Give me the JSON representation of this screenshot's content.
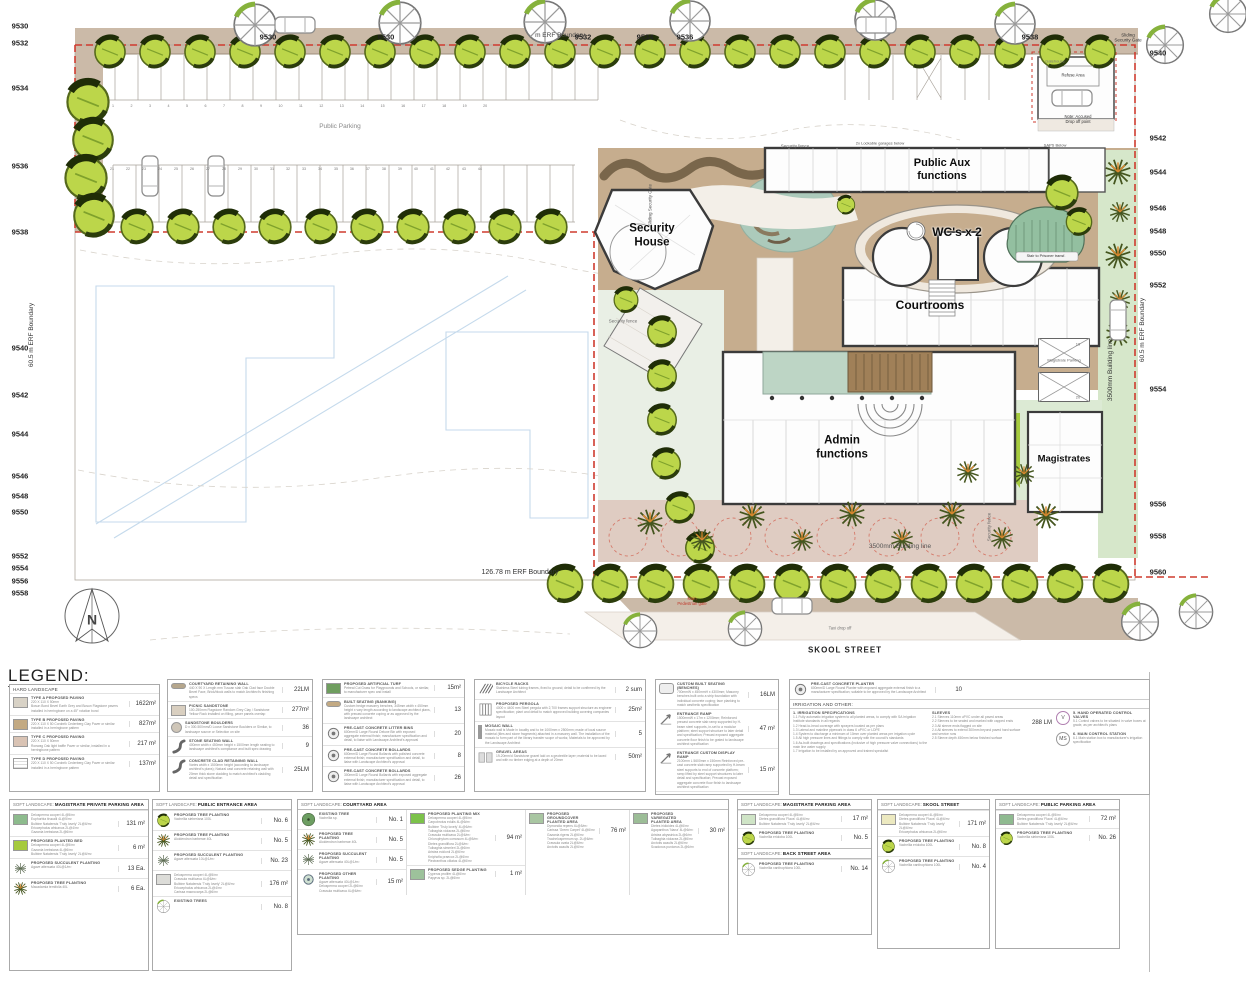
{
  "title": "LEGEND:",
  "plan": {
    "compass": "N",
    "buildings": {
      "security_house": "Security\nHouse",
      "public_aux": "Public Aux\nfunctions",
      "wcs": "WC's x 2",
      "courtrooms": "Courtrooms",
      "admin": "Admin\nfunctions",
      "magistrates": "Magistrates"
    },
    "labels": {
      "skool_street": "SKOOL STREET",
      "erf_left": "60.5 m ERF Boundary",
      "erf_right": "60.5 m ERF Boundary",
      "erf_bottom": "126.78 m ERF Boundary",
      "erf_top": "m ERF Boundary",
      "building_line_v": "3500mm Building line",
      "building_line_h": "3500mm Building line",
      "security_fence": "Security fence",
      "sliding_gate": "Sliding\nSecurity Gate",
      "sliding_gate_v": "Sliding Security Gate",
      "refuse_area": "Refuse Area",
      "gatehouse": "Gatehouse",
      "accused_note": "Note: Accused\nDrop off point",
      "garages_note": "2x Lockable garages below",
      "saps_note": "SAPS Below",
      "prisoner_stair": "Stair to Prisoner transf.",
      "main_gate": "Main\nPedestrian gate",
      "taxi": "Taxi drop off",
      "public_parking": "Public Parking",
      "magistrate_parking": "Magistrate Parking",
      "stall_19": "19",
      "stall_20": "20",
      "stall_numbers_row1": "1 2 3 4 5 6 7 8 9 10 11 12 13 14 15 16 17 18 19 20",
      "stall_numbers_row2": "21 22 23 24 25 26 27 28 29 30 31 32 33 34 35 36 37 38 39 40 41 42 43 44"
    },
    "contours": {
      "top": [
        "9530",
        "9530",
        "9532",
        "9534",
        "9536",
        "9538"
      ],
      "left": [
        "9530",
        "9532",
        "9534",
        "9536",
        "9538",
        "9540",
        "9542",
        "9544",
        "9546",
        "9548",
        "9550",
        "9552",
        "9554",
        "9556",
        "9558"
      ],
      "right": [
        "9540",
        "9542",
        "9544",
        "9546",
        "9548",
        "9550",
        "9552",
        "9554",
        "9556",
        "9558",
        "9560"
      ]
    }
  },
  "legend": {
    "hard": {
      "header": "HARD LANDSCAPE",
      "a": [
        {
          "n": "TYPE A PROPOSED PAVING",
          "d": "220 X 110 X 50mm\nBosun Bond Bevel Earth Grey and Bosun Flagstone pavers installed in herringbone on a 45° rotation bond",
          "v": "1622m²"
        },
        {
          "n": "TYPE B PROPOSED PAVING",
          "d": "220 X 110 X 50 Corobrik Cederberg Clay Paver or similar installed in a herringbone pattern",
          "v": "827m²"
        },
        {
          "n": "TYPE C PROPOSED PAVING",
          "d": "220 X 110 X 50mm\nRoewag Oak light baffle Paver or similar, installed in a herringbone pattern",
          "v": "217 m²"
        },
        {
          "n": "TYPE D PROPOSED PAVING",
          "d": "220 X 110 X 50 Corobrik Cederberg Clay Paver or similar installed in a herringbone pattern",
          "v": "137m²"
        }
      ],
      "b": [
        {
          "n": "COURTYARD RETAINING WALL",
          "d": "440 X 90 X Length mm Tuscan slab Oak Clad face Double Bevel Face, Brick/block walls to match Architect's finishing specs",
          "v": "22LM"
        },
        {
          "n": "PICNIC SANDSTONE",
          "d": "100-250mm Flagstone Random Grey Clay / Sandstone Yellow Rock installed on filling, paver panels overlap",
          "v": "277m²"
        },
        {
          "n": "SANDSTONE BOULDERS",
          "d": "D x 300-500mm/D Loose Sandstone Boulders or Similar, to landscape source or Selection on site",
          "v": "36"
        },
        {
          "n": "STONE SEATING WALL",
          "d": "400mm width x 450mm height x 1500mm length seating to landscape architect's compliance and built spec drawing",
          "v": "9"
        },
        {
          "n": "CONCRETE CLAD RETAINING WALL",
          "d": "Varies width x 1500mm height (according to landscape architect's plans); Natural cast concrete retaining wall with 20mm thick stone cladding to match architect's cladding detail and specification",
          "v": "25LM"
        }
      ],
      "c": [
        {
          "n": "PROPOSED ARTIFICIAL TURF",
          "d": "Petreal Cut Grass for Playgrounds and Schools, or similar, to manufacturer spec and install",
          "v": "15m²"
        },
        {
          "n": "BUILT SEATING (BANKING)",
          "d": "Custom hedge masonry benches, 345mm width x 450mm height x vary length according to landscape architect plans, with precast concrete coping or as approved by the landscape architect",
          "v": "13"
        },
        {
          "n": "PRE-CAST CONCRETE LITTER BINS",
          "d": "600mm/D Large Round Deluxe Bin with exposed aggregate external finish; manufacturer specification and detail, to liaise with Landscape Architect's approval",
          "v": "20"
        },
        {
          "n": "PRE-CAST CONCRETE BOLLARDS",
          "d": "600mm/D Large Round Bollards with polished concrete external finish; manufacturer specification and detail, to liaise with Landscape Architect's approval",
          "v": "8"
        },
        {
          "n": "PRE-CAST CONCRETE BOLLARDS",
          "d": "300mm/D Large Round Bollards with exposed aggregate external finish; manufacturer specification and detail, to liaise with Landscape Architect's approval",
          "v": "26"
        }
      ],
      "d": [
        {
          "n": "BICYCLE RACKS",
          "d": "Stainless Steel tubing frames, fixed to ground; detail to be confirmed by the Landscape Architect",
          "v": "2 sum"
        },
        {
          "n": "PROPOSED PERGOLA",
          "d": "4000 x 4400 mm Steel pergola with 2,700 frames support structure as engineer specification; plant and detail to match approved building covering companies layout",
          "v": "25m²"
        },
        {
          "n": "MOSAIC WALL",
          "d": "Mosaic wall is Made in locality and to be 1000mm x 2500mm; made of local source material (tiles and stone fragments) attached in a masonry wall. The installation of the mosaic to form part of the library transfer scope of works; Materials to be approved by the Landscape Architect",
          "v": "5"
        },
        {
          "n": "GRAVEL AREAS",
          "d": "19-20mm/d Sandstone gravel laid on a geotextile layer; material to be laced and with no timber edging at a depth of 20mm",
          "v": "50m²"
        }
      ],
      "e": [
        {
          "n": "CUSTOM BUILT SEATING (BENCHES)",
          "d": "700mmW x 450mmH x 4300mm; Masonry benches built onto a strip foundation with individual concrete coping; face planking to match aesthetic specification",
          "v": "16LM"
        },
        {
          "n": "ENTRANCE RAMP",
          "d": "1500mmW x 17m x 1200mm; Reinforced precast concrete slab ramp supported by H-beam steel supports, in-set to a modular platform; steel support structure to later detail and specification; Precast exposed aggregate concrete floor finish to be grated to landscape architect specification",
          "v": "47 m²"
        },
        {
          "n": "ENTRANCE CUSTOM DISPLAY RAMP",
          "d": "2100mm L 5600mm x 150mm Reinforced pre-cast concrete slab ramp supported by H-beam steel supports to end of concrete platform; ramp lifted by steel support structures to later detail and specification; Precast exposed aggregate concrete floor finish to landscape architect specification",
          "v": "15 m²"
        },
        {
          "n": "ARTISTIC STEEL SCREENWALL",
          "d": "L-Shaped panels; coated steel of various heights with laser-cut floral art; to be fixed onto fill beam; to later technical detail and specification",
          "v": "23 LM"
        }
      ],
      "f": {
        "n": "PRE-CAST CONCRETE PLANTER",
        "d": "600mm/D Large Round Planter with exposed aggregate external finish to a manufacturer specification; suitable to be approved by the Landscape Architect",
        "v": "10"
      },
      "irr": {
        "header": "IRRIGATION AND OTHER:",
        "spec_t": "1.   IRRIGATION SPECIFICATIONS",
        "spec_x": "1.1 Fully automatic irrigation system to all planted areas, to comply with SA Irrigation Institute standards in all regards\n1.2 Head-to-head coverage with sprayers located as per plans\n1.3 Lateral and mainline pipework in class 6 uPVC or LDPE\n1.4 System to discharge a minimum of 10mm over planted areas per irrigation cycle\n1.5 All high pressure lines and fittings to comply with the council's standards\n1.6 As-built drawings and specifications (inclusive of high pressure valve connections) to the main line water supply\n1.7 Irrigation to be installed by an approved and trained specialist",
        "slv_t": "SLEEVES",
        "slv_x": "2.1 Sleeves 110mm uPVC under all paved areas\n2.2 Sleeves to be sealed and marked with capped ends\n2.3 All sleeve ends flagged on site\n2.4 All sleeves to extend 300mm beyond paved hard surface and service runs\n2.5 Sleeve depth 450mm below finished surface",
        "slv_v": "288 LM",
        "v_icon": "V",
        "v_t": "5.   HAND OPERATED CONTROL VALVES",
        "v_x": "5.1 Control valves to be situated in valve boxes at grade, as per architect's plans",
        "ms_icon": "MS",
        "ms_t": "6. MAIN CONTROL STATION",
        "ms_x": "6.1 Main station box to manufacturer's irrigation specification"
      }
    },
    "soft": {
      "prefix": "SOFT LANDSCAPE:",
      "s1": {
        "t": "MAGISTRATE PRIVATE PARKING AREA",
        "items": [
          {
            "n": "",
            "s": "Delosperma cooperi 4L@5/m²\nEuphorbia tirucalli 4L@5/m²\nBulbine Natalensis 'Truly lovely' 2L@6/m²\nEriocephalus africanus 2L@4/m²\nGazania krebsiana 2L@6/m²",
            "v": "131 m²"
          },
          {
            "n": "PROPOSED PLANTED BED",
            "s": "Delosperma cooperi 4L@5/m²\nGazania krebsiana 4L@6/m²\nBulbine Natalensis 'Truly lovely' 2L@6/m²",
            "v": "6 m²"
          },
          {
            "n": "PROPOSED SUCCULENT PLANTING",
            "s": "Agave attenuata 40L@1/m²",
            "v": "13 Ea."
          },
          {
            "n": "PROPOSED TREE PLANTING",
            "s": "Macadamia ternifolia 40L",
            "v": "6 Ea."
          }
        ]
      },
      "s2": {
        "t": "PUBLIC ENTRANCE AREA",
        "items": [
          {
            "n": "PROPOSED TREE PLANTING",
            "s": "Vachellia sieberiana 100L",
            "v": "No. 6"
          },
          {
            "n": "PROPOSED TREE PLANTING",
            "s": "Aloidendron barberae 40L",
            "v": "No. 5"
          },
          {
            "n": "PROPOSED SUCCULENT PLANTING",
            "s": "Agave attenuata 10L@1/m²",
            "v": "No. 23"
          },
          {
            "n": "",
            "s": "Delosperma cooperi 4L@5/m²\nCrassula multicava 4L@6/m²\nBulbine Natalensis 'Truly lovely' 2L@6/m²\nEriocephalus africanus 2L@4/m²\nCarissa macrocarpa 2L@6/m²",
            "v": "176 m²"
          },
          {
            "n": "EXISTING TREES",
            "s": "",
            "v": "No. 8"
          }
        ]
      },
      "s3": {
        "t": "COURTYARD AREA",
        "items": [
          {
            "n": "EXISTING TREE",
            "s": "Vachellia sp.",
            "v": "No. 1"
          },
          {
            "n": "PROPOSED TREE PLANTING",
            "s": "Aloidendron barberae 40L",
            "v": "No. 5"
          },
          {
            "n": "PROPOSED SUCCULENT PLANTING",
            "s": "Agave attenuata 40L@1/m²",
            "v": "No. 5"
          },
          {
            "n": "PROPOSED OTHER PLANTING",
            "s": "Agave attenuata 40L@1/m²\nDelosperma cooperi 2L@6/m²\nCrassula multicava 4L@6/m²",
            "v": "15 m²"
          },
          {
            "n": "PROPOSED PLANTING MIX",
            "s": "Delosperma cooperi 4L@5/m²\nCarpobrotus edulis 4L@6/m²\nBulbine 'Truly lovely' 4L@6/m²\nTulbaghia violacea 2L@6/m²\nCrassula multicava 2L@6/m²\nChlorophytum comosum 4L@5/m²\nDietes grandiflora 2L@6/m²\nTulbaghia simmleri 2L@6/m²\nAristea ecklonii 2L@6/m²\nKniphofia praecox 2L@6/m²\nPlectranthus ciliatus 4L@6/m²",
            "v": "94 m²"
          },
          {
            "n": "PROPOSED SEDGE PLANTING",
            "s": "Cyperus prolifer 4L@6/m²\nPapyrus sp. 2L@6/m²",
            "v": "1 m²"
          },
          {
            "n": "PROPOSED GROUNDCOVER PLANTED AREA",
            "s": "Dymondia repens 4L@5/m²\nCarissa 'Green Carpet' 4L@6/m²\nGazania rigens 2L@6/m²\nTrachelospermum sp. 2L@6/m²\nCrassula ovata 2L@6/m²\nArctotis acaulis 2L@6/m²",
            "v": "76 m²"
          },
          {
            "n": "PROPOSED VARIEGATED PLANTED AREA",
            "s": "Dietes iridioides 4L@6/m²\nAgapanthus 'Nana' 4L@6/m²\nAristea abyssinica 2L@6/m²\nTulbaghia violacea 2L@6/m²\nArctotis acaulis 2L@6/m²\nScadoxus puniceus 2L@6/m²",
            "v": "30 m²"
          }
        ]
      },
      "s4": {
        "t": "MAGISTRATE PARKING AREA",
        "items": [
          {
            "n": "",
            "s": "Delosperma cooperi 4L@5/m²\nDietes grandiflora 'Flava' 4L@6/m²\nBulbine Natalensis 'Truly lovely' 2L@6/m²",
            "v": "17 m²"
          },
          {
            "n": "PROPOSED TREE PLANTING",
            "s": "Vachellia erioloba 100L",
            "v": "No. 5"
          }
        ]
      },
      "s4b": {
        "t": "BACK STREET AREA",
        "items": [
          {
            "n": "PROPOSED TREE PLANTING",
            "s": "Vachellia xanthophloea 100L",
            "v": "No. 14"
          }
        ]
      },
      "s5": {
        "t": "SKOOL STREET",
        "items": [
          {
            "n": "",
            "s": "Delosperma cooperi 4L@5/m²\nDietes grandiflora 'Flava' 4L@6/m²\nBulbine Natalensis 'Truly lovely' 2L@6/m²\nEriocephalus africanus 2L@6/m²",
            "v": "171 m²"
          },
          {
            "n": "PROPOSED TREE PLANTING",
            "s": "Vachellia erioloba 100L",
            "v": "No. 8"
          },
          {
            "n": "PROPOSED TREE PLANTING",
            "s": "Vachellia xanthophloea 100L",
            "v": "No. 4"
          }
        ]
      },
      "s6": {
        "t": "PUBLIC PARKING AREA",
        "items": [
          {
            "n": "",
            "s": "Delosperma cooperi 4L@5/m²\nDietes grandiflora 'Flava' 4L@6/m²\nBulbine Natalensis 'Truly lovely' 2L@6/m²",
            "v": "72 m²"
          },
          {
            "n": "PROPOSED TREE PLANTING",
            "s": "Vachellia sieberiana 100L",
            "v": "No. 26"
          }
        ]
      }
    }
  }
}
